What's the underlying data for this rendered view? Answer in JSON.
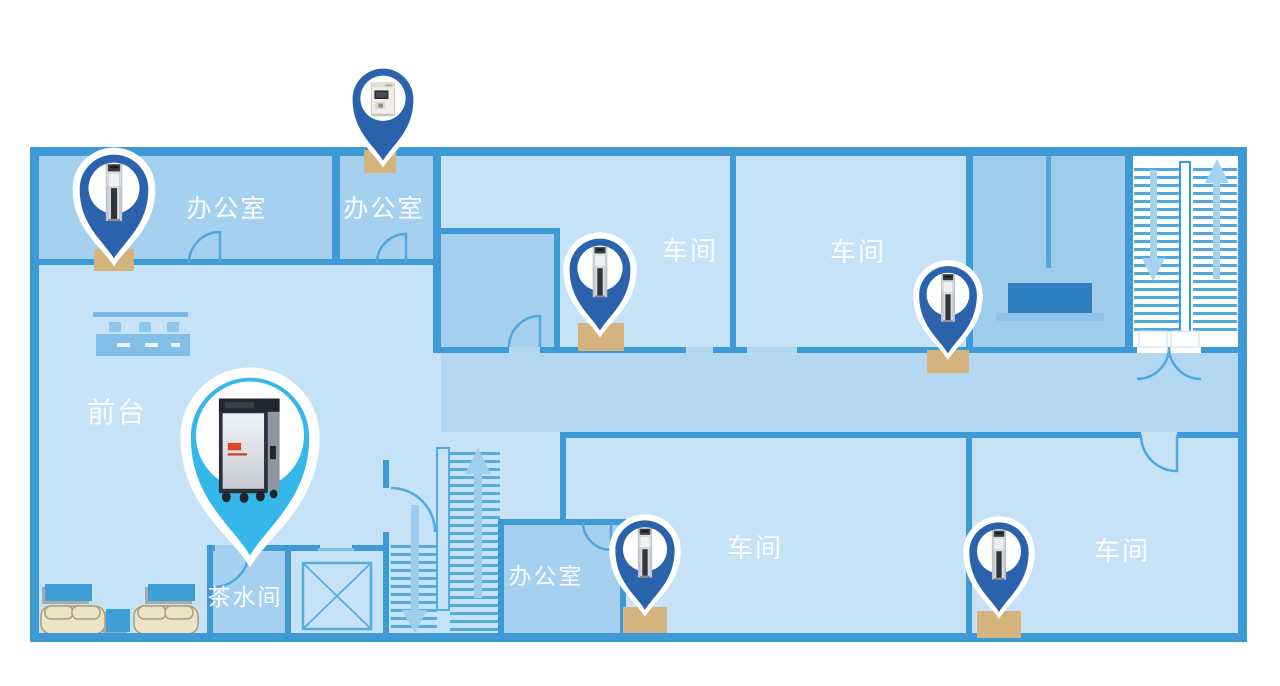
{
  "map": {
    "type": "building-floor-plan",
    "theme": "water-dispenser-placement",
    "background": "#FFFFFF"
  },
  "rooms": {
    "office_top_1": "办公室",
    "office_top_2": "办公室",
    "workshop_top_mid": "车间",
    "workshop_top_right": "车间",
    "front_desk": "前台",
    "tea_room": "茶水间",
    "office_bottom": "办公室",
    "workshop_bottom_mid": "车间",
    "workshop_bottom_right": "车间"
  },
  "pins": [
    {
      "id": "office-top-1",
      "marker_color": "#2A63AC",
      "device": "floor-standing-dispenser"
    },
    {
      "id": "office-top-2",
      "marker_color": "#2A63AC",
      "device": "countertop-dispenser"
    },
    {
      "id": "workshop-top-mid",
      "marker_color": "#2A63AC",
      "device": "floor-standing-dispenser"
    },
    {
      "id": "workshop-top-right",
      "marker_color": "#2A63AC",
      "device": "floor-standing-dispenser"
    },
    {
      "id": "office-bottom",
      "marker_color": "#2A63AC",
      "device": "floor-standing-dispenser"
    },
    {
      "id": "workshop-bottom-right",
      "marker_color": "#2A63AC",
      "device": "floor-standing-dispenser"
    },
    {
      "id": "tea-room-featured",
      "marker_color": "#35B7E9",
      "device": "large-water-purifier",
      "featured": true
    }
  ],
  "colors": {
    "wall": "#3E9AD5",
    "room_light": "#C6E2F7",
    "room_medium": "#A5D0EF",
    "corridor": "#B3D7F1",
    "room_desk": "#A0CCEC",
    "marker_blue": "#2A63AC",
    "marker_cyan": "#35B7E9",
    "pad_tan": "#D4B47C",
    "furniture_blue": "#3E9FD8",
    "sofa_cream": "#ECE4C4",
    "desk_dark": "#2E7FBF",
    "background": "#FFFFFF"
  }
}
